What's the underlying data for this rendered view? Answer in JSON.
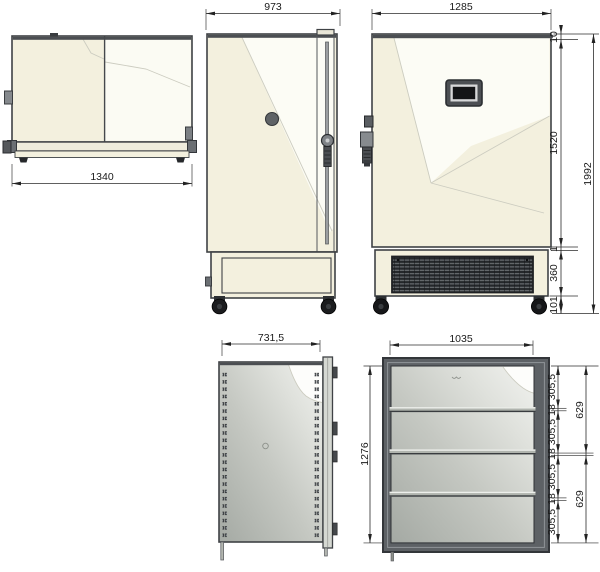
{
  "drawing": {
    "title": "freezer-cabinet-technical-drawing",
    "views": {
      "top": {
        "dim_width": "1340"
      },
      "side": {
        "dim_width": "973"
      },
      "front": {
        "dim_width": "1285",
        "dim_lid": "10",
        "dim_door": "1520",
        "dim_gap": "1",
        "dim_base": "360",
        "dim_caster": "101",
        "dim_total": "1992"
      },
      "interior_side": {
        "dim_width": "731,5"
      },
      "interior_front": {
        "dim_width": "1035",
        "dim_height": "1276",
        "dim_shelves": [
          "305,5",
          "18",
          "305,5",
          "18",
          "305,5",
          "18",
          "305,5"
        ],
        "dim_spans": [
          "629",
          "629"
        ]
      }
    },
    "colors": {
      "panel_cream": "#f3f0de",
      "panel_highlight": "#fcfcf5",
      "outline": "#3f4245",
      "interior_gray_dark": "#a4a9a3",
      "interior_gray_light": "#f2f3f0",
      "grille_dark": "#24272a",
      "dimension_line": "#2b2b2b"
    }
  }
}
